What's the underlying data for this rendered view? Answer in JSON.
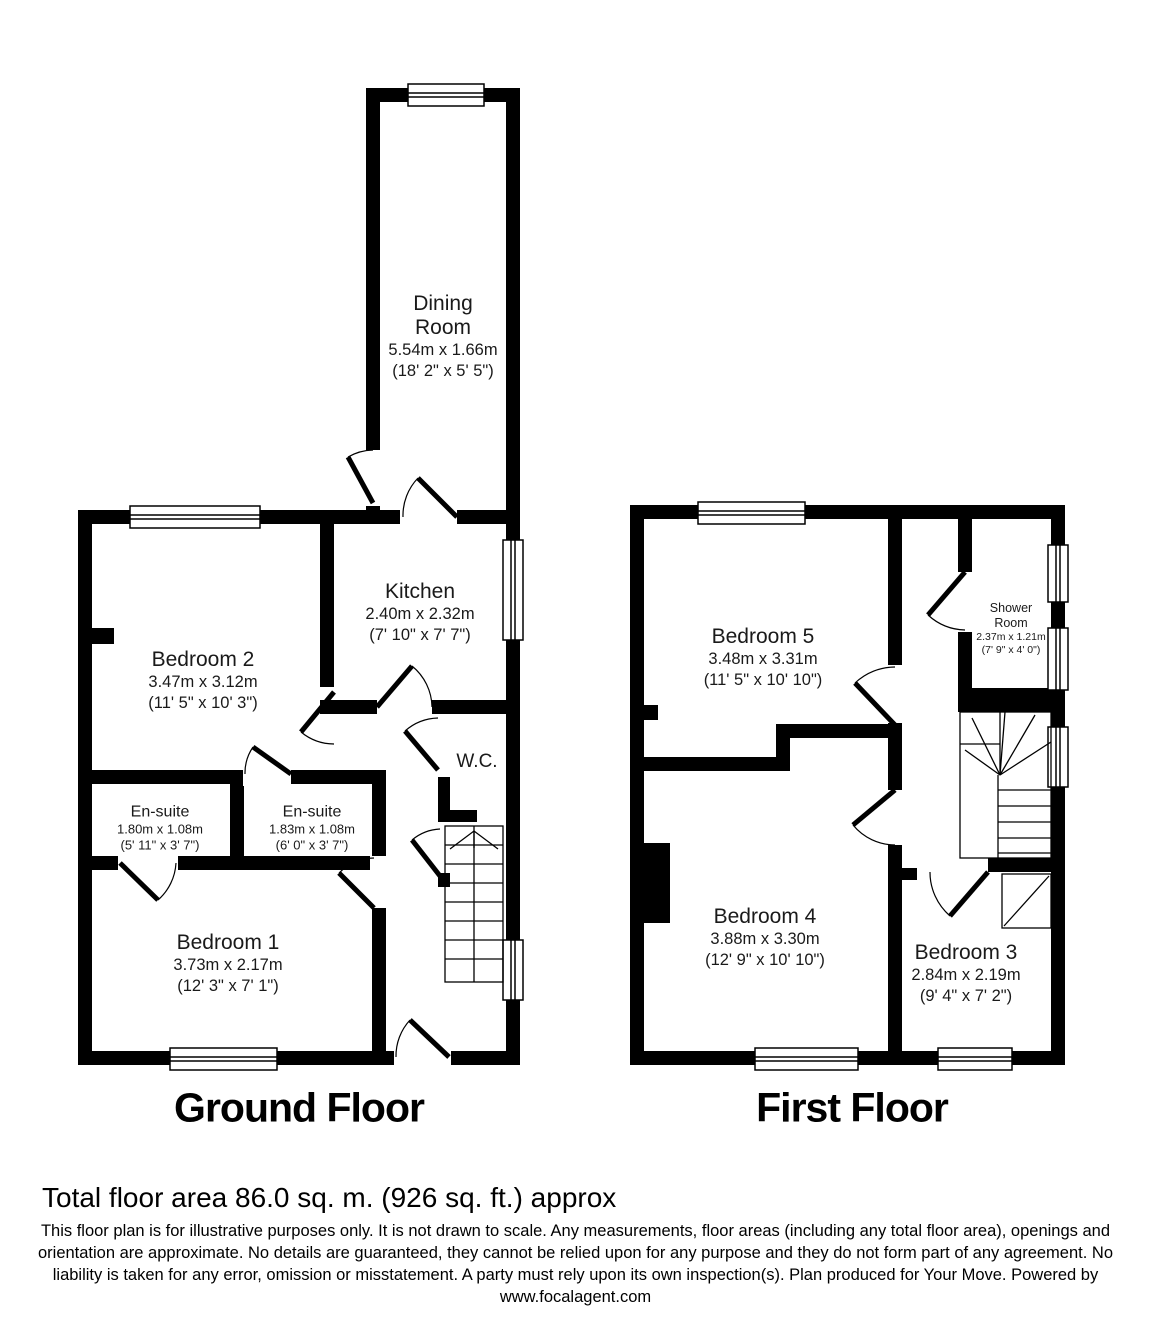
{
  "ground_floor": {
    "title": "Ground Floor",
    "rooms": {
      "dining": {
        "name": "Dining Room",
        "dims_m": "5.54m x 1.66m",
        "dims_ft": "(18' 2\" x 5' 5\")"
      },
      "kitchen": {
        "name": "Kitchen",
        "dims_m": "2.40m x 2.32m",
        "dims_ft": "(7' 10\" x 7' 7\")"
      },
      "bedroom2": {
        "name": "Bedroom 2",
        "dims_m": "3.47m x 3.12m",
        "dims_ft": "(11' 5\" x 10' 3\")"
      },
      "ensuite1": {
        "name": "En-suite",
        "dims_m": "1.80m x 1.08m",
        "dims_ft": "(5' 11\" x 3' 7\")"
      },
      "ensuite2": {
        "name": "En-suite",
        "dims_m": "1.83m x 1.08m",
        "dims_ft": "(6' 0\" x 3' 7\")"
      },
      "wc": {
        "name": "W.C."
      },
      "bedroom1": {
        "name": "Bedroom 1",
        "dims_m": "3.73m x 2.17m",
        "dims_ft": "(12' 3\" x 7' 1\")"
      }
    }
  },
  "first_floor": {
    "title": "First Floor",
    "rooms": {
      "bedroom5": {
        "name": "Bedroom 5",
        "dims_m": "3.48m x 3.31m",
        "dims_ft": "(11' 5\" x 10' 10\")"
      },
      "shower": {
        "name": "Shower Room",
        "dims_m": "2.37m x 1.21m",
        "dims_ft": "(7' 9\" x 4' 0\")"
      },
      "bedroom4": {
        "name": "Bedroom 4",
        "dims_m": "3.88m x 3.30m",
        "dims_ft": "(12' 9\" x 10' 10\")"
      },
      "bedroom3": {
        "name": "Bedroom 3",
        "dims_m": "2.84m x 2.19m",
        "dims_ft": "(9' 4\" x 7' 2\")"
      }
    }
  },
  "footer": {
    "total_area": "Total floor area 86.0 sq. m. (926 sq. ft.) approx",
    "disclaimer": "This floor plan is for illustrative purposes only. It is not drawn to scale. Any measurements, floor areas (including any total floor area), openings and orientation are approximate. No details are guaranteed, they cannot be relied upon for any purpose and they do not form part of any agreement. No liability is taken for any error, omission or misstatement. A party must rely upon its own inspection(s). Plan produced for Your Move. Powered by www.focalagent.com"
  },
  "colors": {
    "wall": "#000000",
    "background": "#ffffff"
  }
}
